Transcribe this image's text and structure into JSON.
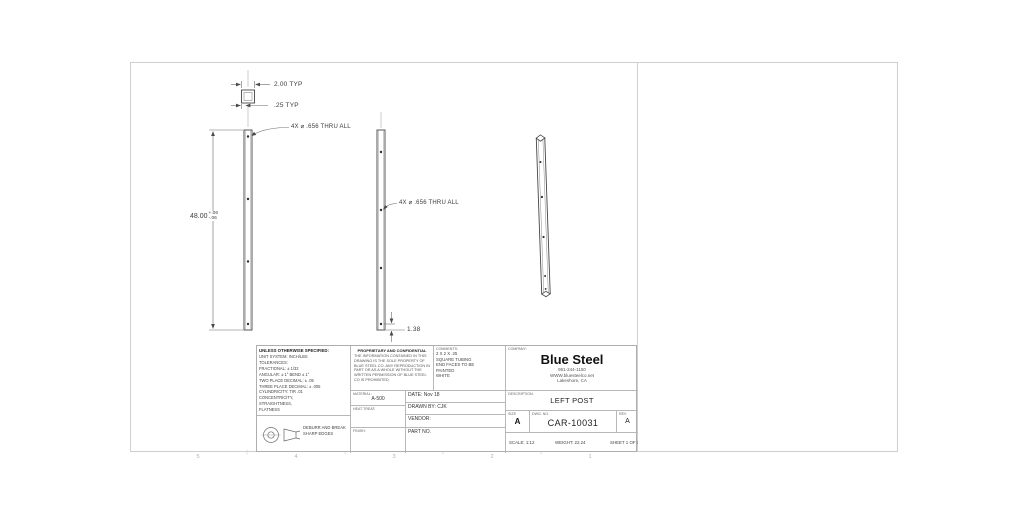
{
  "drawing": {
    "dims": {
      "width_typ": "2.00 TYP",
      "wall_typ": ".25 TYP",
      "length": "48.00",
      "length_tol_plus": "+.06",
      "length_tol_minus": "-.06",
      "hole_callout_1": "4X ⌀ .656 THRU ALL",
      "hole_callout_2": "4X ⌀ .656 THRU ALL",
      "hole_end_offset": "1.38"
    },
    "zones": [
      "5",
      "4",
      "3",
      "2",
      "1"
    ]
  },
  "title_block": {
    "tolerances": {
      "header": "UNLESS OTHERWISE SPECIFIED:",
      "lines": [
        "UNIT SYSTEM: INCH/LBS",
        "TOLERANCES:",
        "FRACTIONAL: ± 1/32",
        "ANGULAR: ± 1°  BEND ± 1°",
        "TWO PLACE DECIMAL:   ± .05",
        "THREE PLACE DECIMAL: ± .005",
        "CYLINDRICITY: TIR .01",
        "CONCENTRICITY,",
        "STRAIGHTNESS,",
        "FLATNESS"
      ]
    },
    "projection_note": {
      "line1": "DEBURR AND BREAK",
      "line2": "SHARP EDGES"
    },
    "proprietary": {
      "header": "PROPRIETARY AND CONFIDENTIAL",
      "body": "THE INFORMATION CONTAINED IN THIS DRAWING IS THE SOLE PROPERTY OF BLUE STEEL CO.  ANY REPRODUCTION IN PART OR AS A WHOLE WITHOUT THE WRITTEN PERMISSION OF BLUE STEEL CO IS PROHIBITED."
    },
    "comments": {
      "label": "COMMENTS:",
      "lines": [
        "2 X 2 X .25",
        "SQUARE TUBING",
        "",
        "END FACES TO BE",
        "PAINTED",
        "WHITE"
      ]
    },
    "company": {
      "label": "COMPANY:",
      "name": "Blue Steel",
      "phone": "951-244-1150",
      "website": "WWW.bluesteelco.net",
      "location": "Lakeshore, CA"
    },
    "material": {
      "label": "MATERIAL:",
      "value": "A-500"
    },
    "heat_treat": {
      "label": "HEAT TREAT:",
      "value": ""
    },
    "finish": {
      "label": "FINISH:",
      "value": ""
    },
    "date": {
      "label": "DATE:",
      "value": "Nov 18"
    },
    "drawn_by": {
      "label": "DRAWN BY:",
      "value": "CJK"
    },
    "vendor": {
      "label": "VENDOR:",
      "value": ""
    },
    "part_no": {
      "label": "PART NO.",
      "value": ""
    },
    "description": {
      "label": "DESCRIPTION:",
      "value": "LEFT POST"
    },
    "size": {
      "label": "SIZE",
      "value": "A"
    },
    "dwg_no": {
      "label": "DWG.  NO.",
      "value": "CAR-10031"
    },
    "rev": {
      "label": "REV",
      "value": "A"
    },
    "scale": "SCALE: 1:12",
    "weight": "WEIGHT: 22.24",
    "sheet": "SHEET 1 OF 1"
  }
}
